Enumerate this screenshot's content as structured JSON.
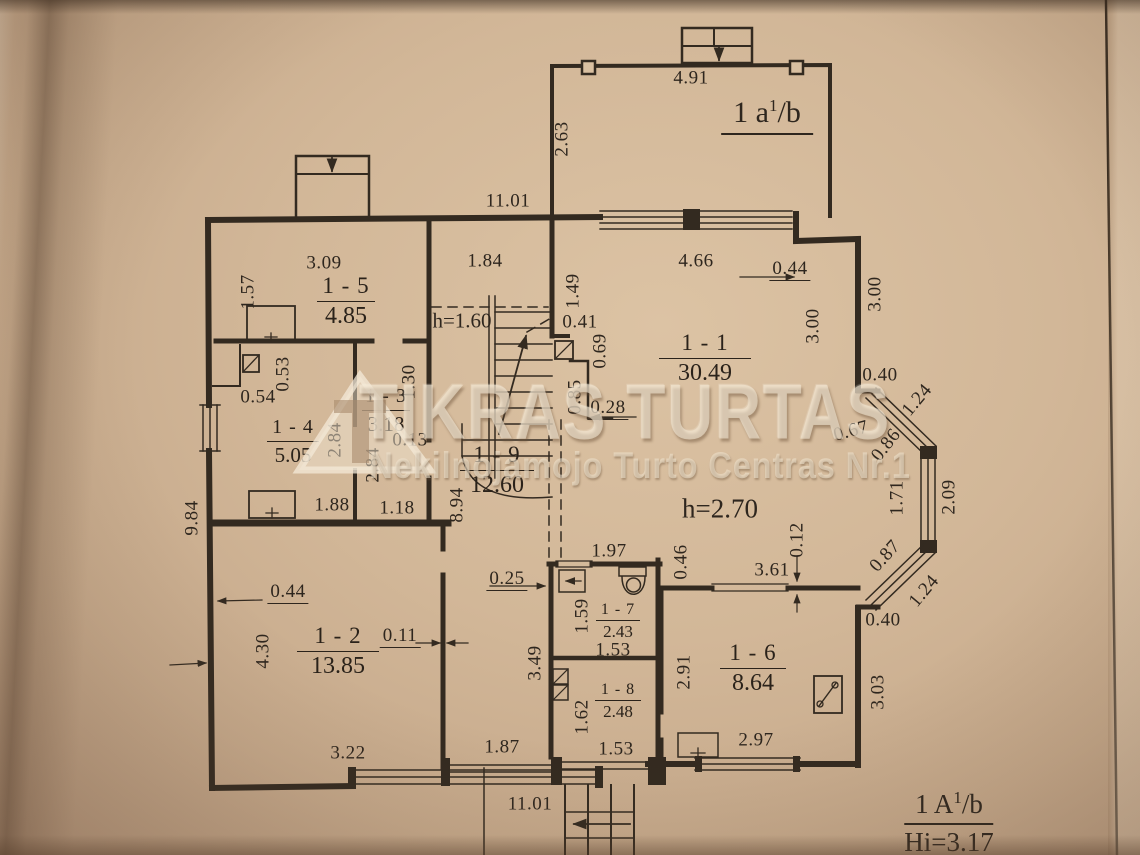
{
  "colors": {
    "paper": "#d2b798",
    "line": "#332a20",
    "watermark": "#f3e8d4"
  },
  "watermark": {
    "title": "TIKRAS TURTAS",
    "subtitle": "Nekilnojamojo Turto Centras Nr.1"
  },
  "plan": {
    "unit_top": {
      "prefix": "1 a",
      "sup": "1",
      "suffix": "/b"
    },
    "unit_bottom": {
      "prefix": "1 A",
      "sup": "1",
      "suffix": "/b",
      "height": "Hi=3.17"
    },
    "notes": [
      {
        "t": "h=1.60",
        "x": 462,
        "y": 321,
        "fs": 21
      },
      {
        "t": "h=2.70",
        "x": 720,
        "y": 509,
        "fs": 27
      }
    ],
    "rooms": [
      {
        "id": "1 - 5",
        "area": "4.85",
        "x": 346,
        "y": 274,
        "w": 58,
        "cls": ""
      },
      {
        "id": "1 - 4",
        "area": "5.05",
        "x": 293,
        "y": 417,
        "w": 52,
        "cls": "rm-m"
      },
      {
        "id": "1 - 3",
        "area": "3.18",
        "x": 386,
        "y": 386,
        "w": 48,
        "cls": "rm-m"
      },
      {
        "id": "1 - 9",
        "area": "12.60",
        "x": 497,
        "y": 443,
        "w": 74,
        "cls": ""
      },
      {
        "id": "1 - 1",
        "area": "30.49",
        "x": 705,
        "y": 331,
        "w": 92,
        "cls": ""
      },
      {
        "id": "1 - 2",
        "area": "13.85",
        "x": 338,
        "y": 624,
        "w": 82,
        "cls": ""
      },
      {
        "id": "1 - 7",
        "area": "2.43",
        "x": 618,
        "y": 601,
        "w": 44,
        "cls": "rm-s"
      },
      {
        "id": "1 - 8",
        "area": "2.48",
        "x": 618,
        "y": 681,
        "w": 46,
        "cls": "rm-s"
      },
      {
        "id": "1 - 6",
        "area": "8.64",
        "x": 753,
        "y": 641,
        "w": 66,
        "cls": ""
      }
    ],
    "dimensions": [
      {
        "t": "4.91",
        "x": 691,
        "y": 78
      },
      {
        "t": "2.63",
        "x": 562,
        "y": 139,
        "r": -90
      },
      {
        "t": "11.01",
        "x": 508,
        "y": 201
      },
      {
        "t": "3.09",
        "x": 324,
        "y": 263
      },
      {
        "t": "1.57",
        "x": 248,
        "y": 292,
        "r": -90
      },
      {
        "t": "1.84",
        "x": 485,
        "y": 261
      },
      {
        "t": "4.66",
        "x": 696,
        "y": 261
      },
      {
        "t": "0.44",
        "x": 790,
        "y": 270,
        "u": 1
      },
      {
        "t": "3.00",
        "x": 813,
        "y": 326,
        "r": -90
      },
      {
        "t": "3.00",
        "x": 875,
        "y": 294,
        "r": -90
      },
      {
        "t": "1.49",
        "x": 573,
        "y": 291,
        "r": -90
      },
      {
        "t": "0.41",
        "x": 580,
        "y": 322
      },
      {
        "t": "0.69",
        "x": 600,
        "y": 351,
        "r": -90
      },
      {
        "t": "0.85",
        "x": 575,
        "y": 397,
        "r": -90
      },
      {
        "t": "0.28",
        "x": 608,
        "y": 409,
        "u": 1
      },
      {
        "t": "0.40",
        "x": 880,
        "y": 375
      },
      {
        "t": "1.24",
        "x": 917,
        "y": 400,
        "r": -50
      },
      {
        "t": "0.67",
        "x": 851,
        "y": 431,
        "r": -15
      },
      {
        "t": "0.86",
        "x": 886,
        "y": 445,
        "r": -52
      },
      {
        "t": "1.71",
        "x": 897,
        "y": 498,
        "r": -90
      },
      {
        "t": "2.09",
        "x": 949,
        "y": 497,
        "r": -90
      },
      {
        "t": "0.87",
        "x": 885,
        "y": 556,
        "r": -48
      },
      {
        "t": "1.24",
        "x": 924,
        "y": 591,
        "r": -50
      },
      {
        "t": "0.40",
        "x": 883,
        "y": 620
      },
      {
        "t": "0.53",
        "x": 283,
        "y": 374,
        "r": -90
      },
      {
        "t": "0.54",
        "x": 258,
        "y": 397
      },
      {
        "t": "1.30",
        "x": 409,
        "y": 382,
        "r": -90
      },
      {
        "t": "0.13",
        "x": 410,
        "y": 440
      },
      {
        "t": "2.84",
        "x": 335,
        "y": 440,
        "r": -90
      },
      {
        "t": "2.84",
        "x": 373,
        "y": 465,
        "r": -90
      },
      {
        "t": "1.88",
        "x": 332,
        "y": 505
      },
      {
        "t": "1.18",
        "x": 397,
        "y": 508
      },
      {
        "t": "8.94",
        "x": 457,
        "y": 505,
        "r": -90
      },
      {
        "t": "9.84",
        "x": 192,
        "y": 518,
        "r": -90
      },
      {
        "t": "0.25",
        "x": 507,
        "y": 580,
        "u": 1
      },
      {
        "t": "1.97",
        "x": 609,
        "y": 551
      },
      {
        "t": "0.46",
        "x": 681,
        "y": 562,
        "r": -90
      },
      {
        "t": "3.61",
        "x": 772,
        "y": 570
      },
      {
        "t": "0.12",
        "x": 797,
        "y": 540,
        "r": -90
      },
      {
        "t": "1.59",
        "x": 582,
        "y": 616,
        "r": -90
      },
      {
        "t": "1.53",
        "x": 613,
        "y": 650
      },
      {
        "t": "3.49",
        "x": 535,
        "y": 663,
        "r": -90
      },
      {
        "t": "2.91",
        "x": 684,
        "y": 672,
        "r": -90
      },
      {
        "t": "1.62",
        "x": 582,
        "y": 717,
        "r": -90
      },
      {
        "t": "1.53",
        "x": 616,
        "y": 749
      },
      {
        "t": "2.97",
        "x": 756,
        "y": 740
      },
      {
        "t": "3.03",
        "x": 878,
        "y": 692,
        "r": -90
      },
      {
        "t": "0.44",
        "x": 288,
        "y": 593,
        "u": 1
      },
      {
        "t": "4.30",
        "x": 263,
        "y": 651,
        "r": -90
      },
      {
        "t": "0.11",
        "x": 400,
        "y": 637,
        "u": 1
      },
      {
        "t": "3.22",
        "x": 348,
        "y": 753
      },
      {
        "t": "1.87",
        "x": 502,
        "y": 747
      },
      {
        "t": "11.01",
        "x": 530,
        "y": 804
      }
    ]
  }
}
